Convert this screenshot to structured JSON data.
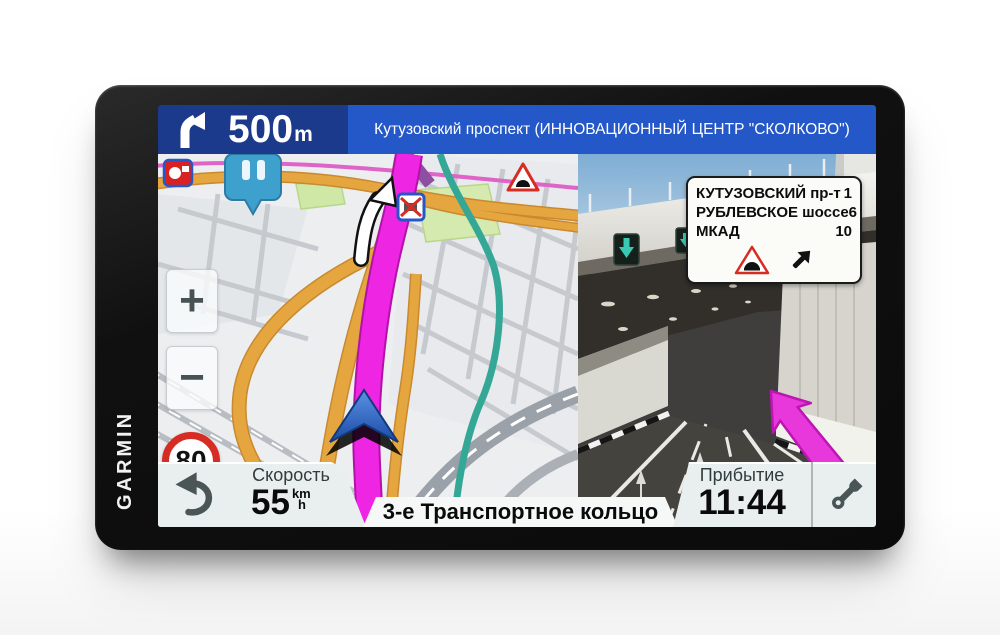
{
  "device": {
    "brand": "GARMIN"
  },
  "navbar": {
    "maneuver_icon": "bear-right-arrow",
    "distance_value": "500",
    "distance_unit": "m",
    "next_street": "Кутузовский проспект (ИННОВАЦИОННЫЙ ЦЕНТР \"СКОЛКОВО\")"
  },
  "map": {
    "zoom_in_label": "+",
    "zoom_out_label": "−",
    "speed_limit": "80",
    "icons": [
      "speed-camera-icon",
      "traffic-pin-icon",
      "no-trucks-sign",
      "tunnel-warning-sign"
    ]
  },
  "junction_view": {
    "sign_rows": [
      {
        "name": "КУТУЗОВСКИЙ пр-т",
        "distance": "1"
      },
      {
        "name": "РУБЛЕВСКОЕ шоссе",
        "distance": "6"
      },
      {
        "name": "МКАД",
        "distance": "10"
      }
    ],
    "sign_icons": [
      "tunnel-warning",
      "bear-right-arrow"
    ]
  },
  "status_bar": {
    "speed_label": "Скорость",
    "speed_value": "55",
    "speed_unit_num": "km",
    "speed_unit_den": "h",
    "current_street": "3-е Транспортное кольцо",
    "arrival_label": "Прибытие",
    "arrival_value": "11:44"
  },
  "colors": {
    "navbar_left": "#1c3a8c",
    "navbar_right": "#2457c8",
    "route": "#ee25e3",
    "panel": "#e9eeee",
    "speed_limit_ring": "#d62c23"
  }
}
